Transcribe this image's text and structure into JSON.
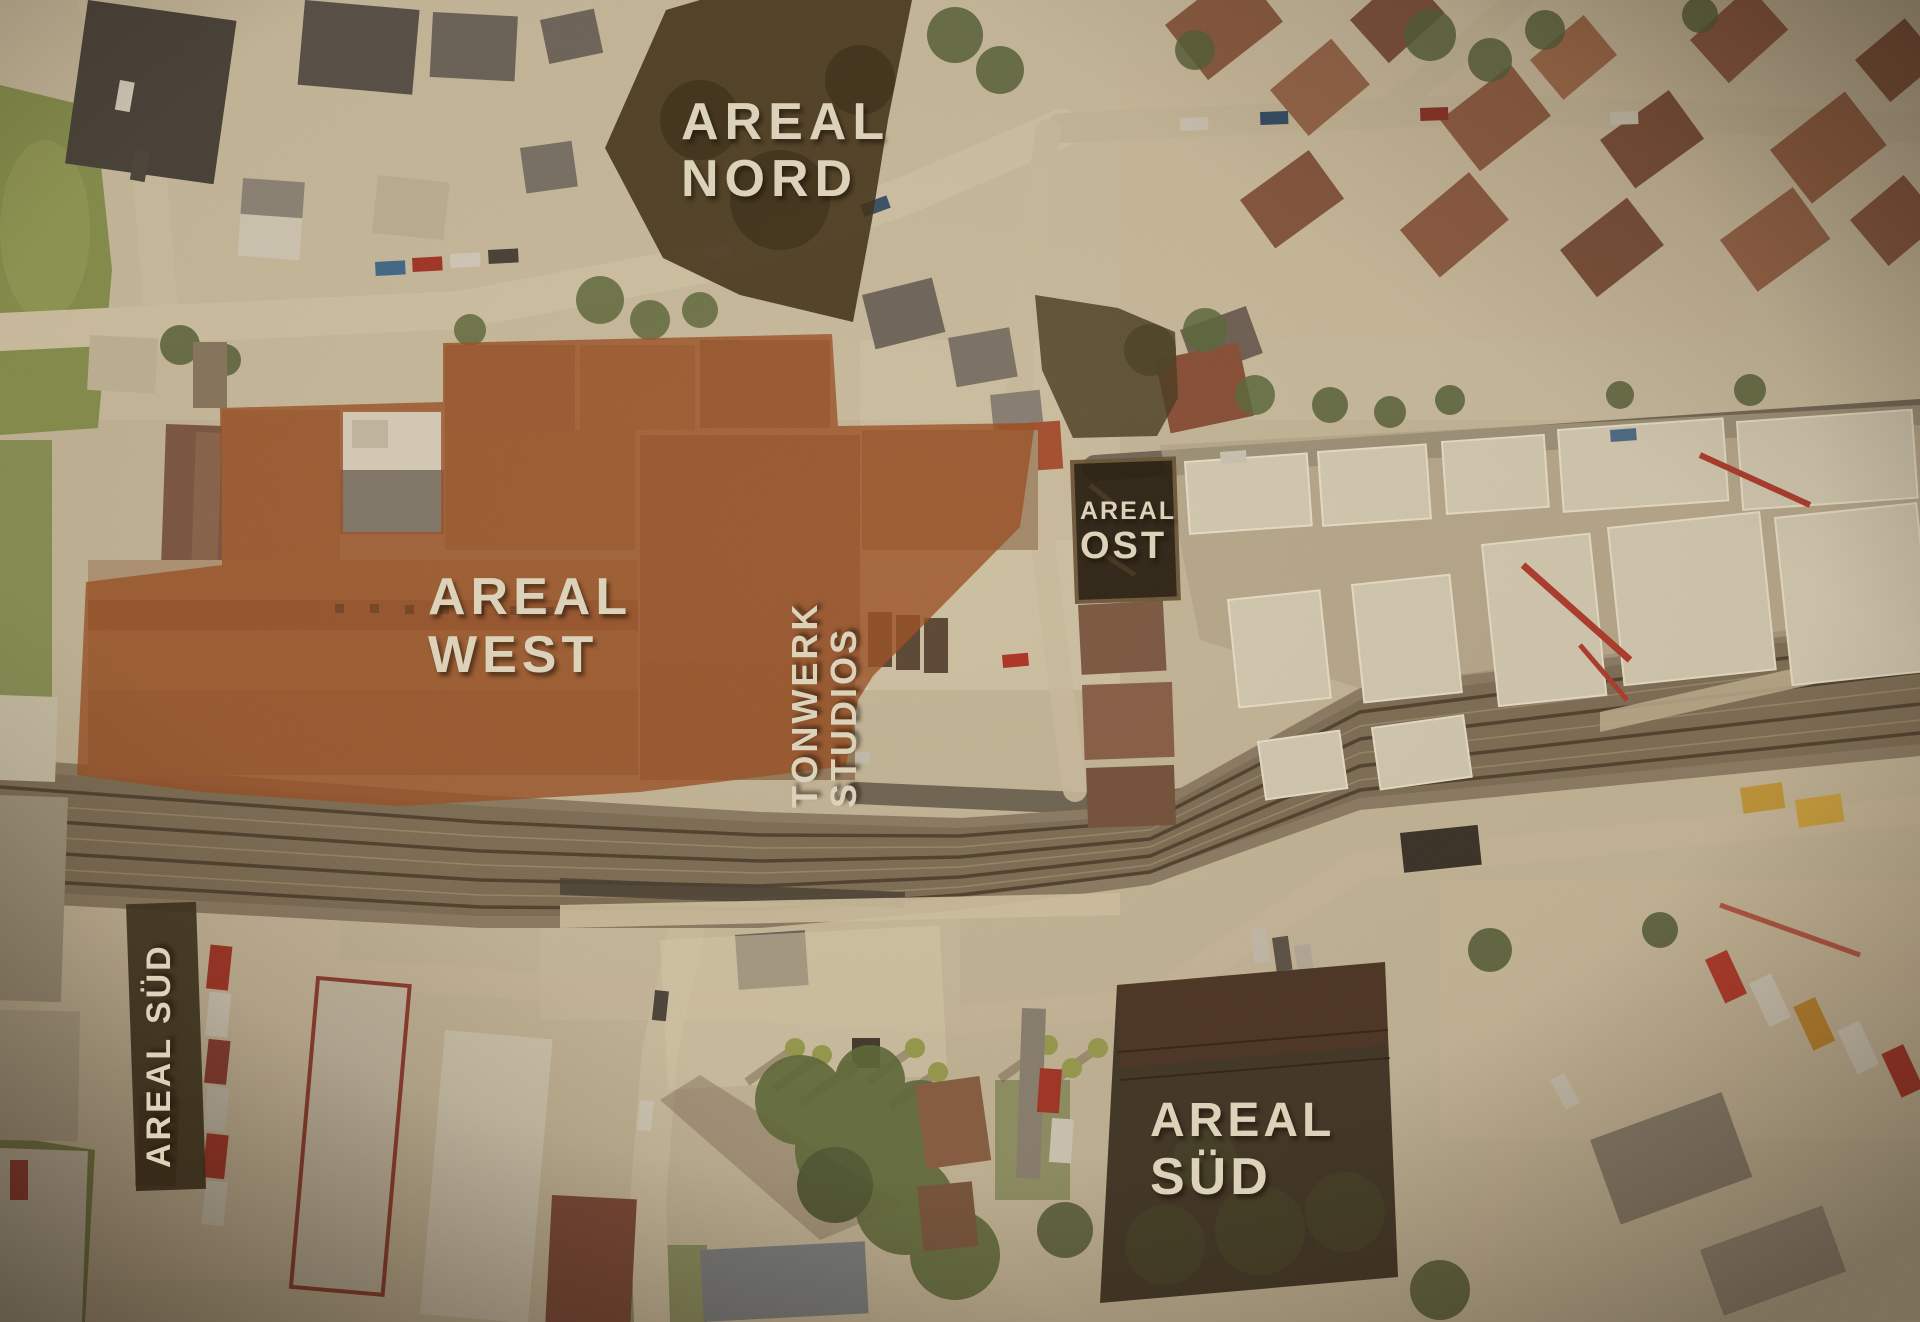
{
  "map": {
    "description": "Aerial site plan with highlighted development areas around a railway line",
    "areas": {
      "nord": {
        "line1": "AREAL",
        "line2": "NORD"
      },
      "west": {
        "line1": "AREAL",
        "line2": "WEST"
      },
      "tonwerk": {
        "line1": "TONWERK",
        "line2": "STUDIOS"
      },
      "ost": {
        "line1": "AREAL",
        "line2": "OST"
      },
      "sued_left": {
        "label": "AREAL SÜD"
      },
      "sued_right": {
        "line1": "AREAL",
        "line2": "SÜD"
      }
    },
    "colors": {
      "west_highlight": "#9d5124",
      "north_overlay": "#3d2f16",
      "ost_overlay": "#473a20",
      "ost_building": "#241c10",
      "sued_building": "#2f2718",
      "sued_strip": "#3a311c",
      "label_text": "#dcd2ba"
    }
  }
}
